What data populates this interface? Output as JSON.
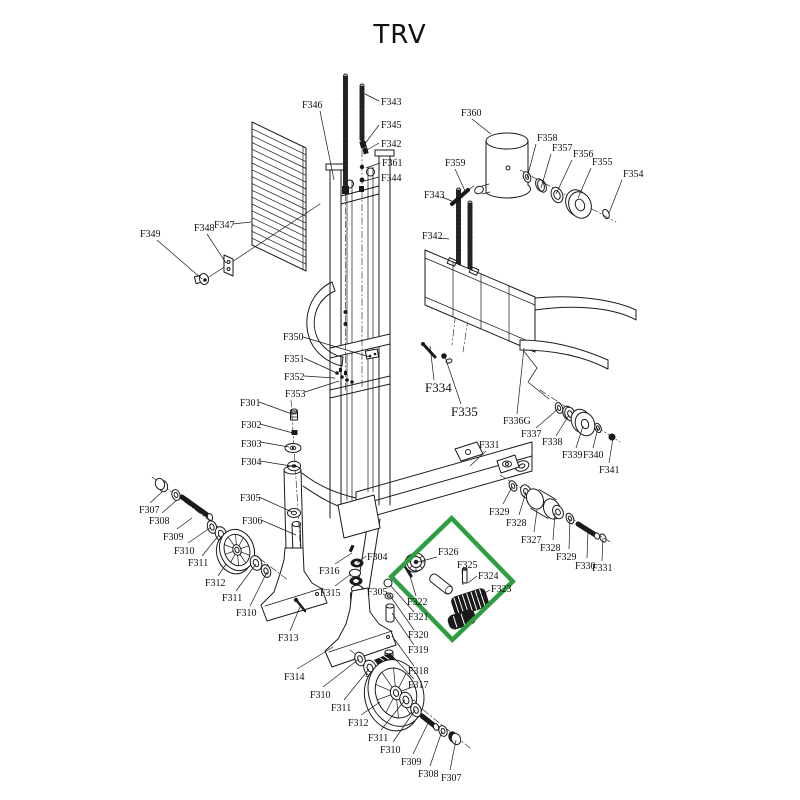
{
  "title": "TRV",
  "highlight": {
    "color": "#2f9e41",
    "cx": 452,
    "cy": 579,
    "w": 88,
    "h": 84,
    "rotation": 46,
    "stroke_width": 4.5
  },
  "diagram": {
    "label_font_size": 10,
    "labels": [
      {
        "t": "F346",
        "x": 302,
        "y": 108,
        "l": [
          320,
          111,
          334,
          180
        ]
      },
      {
        "t": "F343",
        "x": 381,
        "y": 105,
        "l": [
          379,
          101,
          365,
          94
        ]
      },
      {
        "t": "F345",
        "x": 381,
        "y": 128,
        "l": [
          379,
          125,
          364,
          145
        ]
      },
      {
        "t": "F342",
        "x": 381,
        "y": 147,
        "l": [
          379,
          143,
          367,
          150
        ]
      },
      {
        "t": "F361",
        "x": 382,
        "y": 166,
        "l": [
          380,
          163,
          366,
          168
        ]
      },
      {
        "t": "F344",
        "x": 381,
        "y": 181,
        "l": [
          379,
          177,
          364,
          181
        ]
      },
      {
        "t": "F360",
        "x": 461,
        "y": 116,
        "l": [
          472,
          119,
          491,
          134
        ]
      },
      {
        "t": "F358",
        "x": 537,
        "y": 141,
        "l": [
          536,
          144,
          527,
          178
        ]
      },
      {
        "t": "F357",
        "x": 552,
        "y": 151,
        "l": [
          551,
          154,
          541,
          188
        ]
      },
      {
        "t": "F356",
        "x": 573,
        "y": 157,
        "l": [
          572,
          160,
          556,
          194
        ]
      },
      {
        "t": "F355",
        "x": 592,
        "y": 165,
        "l": [
          591,
          168,
          578,
          198
        ]
      },
      {
        "t": "F354",
        "x": 623,
        "y": 177,
        "l": [
          622,
          180,
          609,
          213
        ]
      },
      {
        "t": "F359",
        "x": 445,
        "y": 166,
        "l": [
          455,
          169,
          466,
          193
        ]
      },
      {
        "t": "F343",
        "x": 424,
        "y": 198,
        "l": [
          442,
          197,
          454,
          202
        ]
      },
      {
        "t": "F342",
        "x": 422,
        "y": 239,
        "l": [
          440,
          238,
          449,
          239
        ]
      },
      {
        "t": "F349",
        "x": 140,
        "y": 237,
        "l": [
          157,
          240,
          202,
          279
        ]
      },
      {
        "t": "F348",
        "x": 194,
        "y": 231,
        "l": [
          207,
          234,
          226,
          263
        ]
      },
      {
        "t": "F347",
        "x": 214,
        "y": 228,
        "l": [
          233,
          224,
          251,
          222
        ]
      },
      {
        "t": "F350",
        "x": 283,
        "y": 340,
        "l": [
          303,
          337,
          370,
          357
        ]
      },
      {
        "t": "F351",
        "x": 284,
        "y": 362,
        "l": [
          304,
          358,
          339,
          374
        ]
      },
      {
        "t": "F352",
        "x": 284,
        "y": 380,
        "l": [
          304,
          376,
          335,
          378
        ]
      },
      {
        "t": "F353",
        "x": 285,
        "y": 397,
        "l": [
          305,
          392,
          339,
          381
        ]
      },
      {
        "t": "F334",
        "x": 425,
        "y": 392,
        "s": 13,
        "l": [
          434,
          380,
          430,
          346
        ]
      },
      {
        "t": "F335",
        "x": 451,
        "y": 416,
        "s": 13,
        "l": [
          461,
          404,
          445,
          357
        ]
      },
      {
        "t": "F336G",
        "x": 503,
        "y": 424,
        "l": [
          517,
          414,
          524,
          348
        ]
      },
      {
        "t": "F337",
        "x": 521,
        "y": 437,
        "l": [
          536,
          428,
          558,
          409
        ]
      },
      {
        "t": "F338",
        "x": 542,
        "y": 445,
        "l": [
          556,
          436,
          569,
          415
        ]
      },
      {
        "t": "F339",
        "x": 562,
        "y": 458,
        "l": [
          576,
          448,
          583,
          426
        ]
      },
      {
        "t": "F340",
        "x": 583,
        "y": 458,
        "l": [
          593,
          448,
          598,
          428
        ]
      },
      {
        "t": "F341",
        "x": 599,
        "y": 473,
        "l": [
          609,
          463,
          613,
          438
        ]
      },
      {
        "t": "F331",
        "x": 479,
        "y": 448,
        "l": [
          486,
          451,
          470,
          466
        ]
      },
      {
        "t": "F301",
        "x": 240,
        "y": 406,
        "l": [
          259,
          402,
          292,
          414
        ]
      },
      {
        "t": "F302",
        "x": 241,
        "y": 428,
        "l": [
          260,
          424,
          293,
          433
        ]
      },
      {
        "t": "F303",
        "x": 241,
        "y": 447,
        "l": [
          260,
          442,
          289,
          447
        ]
      },
      {
        "t": "F304",
        "x": 241,
        "y": 465,
        "l": [
          260,
          461,
          291,
          466
        ]
      },
      {
        "t": "F305",
        "x": 240,
        "y": 501,
        "l": [
          259,
          497,
          292,
          512
        ]
      },
      {
        "t": "F306",
        "x": 242,
        "y": 524,
        "l": [
          261,
          520,
          296,
          535
        ]
      },
      {
        "t": "F307",
        "x": 139,
        "y": 513,
        "l": [
          150,
          503,
          163,
          491
        ]
      },
      {
        "t": "F308",
        "x": 149,
        "y": 524,
        "l": [
          162,
          513,
          177,
          500
        ]
      },
      {
        "t": "F309",
        "x": 163,
        "y": 540,
        "l": [
          177,
          529,
          192,
          518
        ]
      },
      {
        "t": "F310",
        "x": 174,
        "y": 554,
        "l": [
          188,
          543,
          210,
          528
        ]
      },
      {
        "t": "F311",
        "x": 188,
        "y": 566,
        "l": [
          202,
          556,
          219,
          535
        ]
      },
      {
        "t": "F312",
        "x": 205,
        "y": 586,
        "l": [
          218,
          576,
          226,
          564
        ]
      },
      {
        "t": "F311",
        "x": 222,
        "y": 601,
        "l": [
          236,
          591,
          256,
          564
        ]
      },
      {
        "t": "F310",
        "x": 236,
        "y": 616,
        "l": [
          250,
          606,
          267,
          572
        ]
      },
      {
        "t": "F313",
        "x": 278,
        "y": 641,
        "l": [
          290,
          631,
          300,
          607
        ]
      },
      {
        "t": "F316",
        "x": 319,
        "y": 574,
        "l": [
          335,
          564,
          352,
          553
        ]
      },
      {
        "t": "F315",
        "x": 320,
        "y": 596,
        "l": [
          335,
          586,
          351,
          574
        ]
      },
      {
        "t": "F304",
        "x": 367,
        "y": 560,
        "l": [
          366,
          556,
          357,
          563
        ]
      },
      {
        "t": "F305",
        "x": 367,
        "y": 595,
        "l": [
          365,
          589,
          360,
          586
        ]
      },
      {
        "t": "F326",
        "x": 438,
        "y": 555,
        "l": [
          437,
          557,
          418,
          562
        ]
      },
      {
        "t": "F325",
        "x": 457,
        "y": 568,
        "l": [
          462,
          570,
          463,
          585
        ]
      },
      {
        "t": "F324",
        "x": 478,
        "y": 579,
        "l": [
          477,
          576,
          468,
          583
        ]
      },
      {
        "t": "F323",
        "x": 491,
        "y": 592,
        "l": [
          490,
          590,
          477,
          597
        ]
      },
      {
        "t": "F322",
        "x": 407,
        "y": 605,
        "l": [
          416,
          596,
          410,
          576
        ]
      },
      {
        "t": "F321",
        "x": 408,
        "y": 620,
        "l": [
          414,
          612,
          390,
          585
        ]
      },
      {
        "t": "F320",
        "x": 408,
        "y": 638,
        "l": [
          414,
          630,
          391,
          597
        ]
      },
      {
        "t": "F319",
        "x": 408,
        "y": 653,
        "l": [
          414,
          645,
          392,
          613
        ]
      },
      {
        "t": "F318",
        "x": 408,
        "y": 674,
        "l": [
          414,
          666,
          392,
          636
        ]
      },
      {
        "t": "F317",
        "x": 408,
        "y": 688,
        "l": [
          414,
          679,
          393,
          657
        ]
      },
      {
        "t": "F314",
        "x": 284,
        "y": 680,
        "l": [
          297,
          669,
          333,
          647
        ]
      },
      {
        "t": "F310",
        "x": 310,
        "y": 698,
        "l": [
          323,
          687,
          359,
          659
        ]
      },
      {
        "t": "F311",
        "x": 331,
        "y": 711,
        "l": [
          344,
          700,
          369,
          669
        ]
      },
      {
        "t": "F312",
        "x": 348,
        "y": 726,
        "l": [
          361,
          715,
          380,
          702
        ]
      },
      {
        "t": "F311",
        "x": 368,
        "y": 741,
        "l": [
          381,
          730,
          405,
          700
        ]
      },
      {
        "t": "F310",
        "x": 380,
        "y": 753,
        "l": [
          393,
          742,
          415,
          710
        ]
      },
      {
        "t": "F309",
        "x": 401,
        "y": 765,
        "l": [
          413,
          754,
          428,
          723
        ]
      },
      {
        "t": "F308",
        "x": 418,
        "y": 777,
        "l": [
          430,
          766,
          442,
          731
        ]
      },
      {
        "t": "F307",
        "x": 441,
        "y": 781,
        "l": [
          450,
          770,
          456,
          740
        ]
      },
      {
        "t": "F329",
        "x": 489,
        "y": 515,
        "l": [
          503,
          504,
          512,
          487
        ]
      },
      {
        "t": "F328",
        "x": 506,
        "y": 526,
        "l": [
          519,
          515,
          526,
          492
        ]
      },
      {
        "t": "F327",
        "x": 521,
        "y": 543,
        "l": [
          534,
          532,
          537,
          510
        ]
      },
      {
        "t": "F328",
        "x": 540,
        "y": 551,
        "l": [
          553,
          540,
          555,
          513
        ]
      },
      {
        "t": "F329",
        "x": 556,
        "y": 560,
        "l": [
          569,
          549,
          570,
          519
        ]
      },
      {
        "t": "F330",
        "x": 575,
        "y": 569,
        "l": [
          587,
          558,
          588,
          531
        ]
      },
      {
        "t": "F331",
        "x": 592,
        "y": 571,
        "l": [
          602,
          561,
          603,
          538
        ]
      }
    ]
  }
}
